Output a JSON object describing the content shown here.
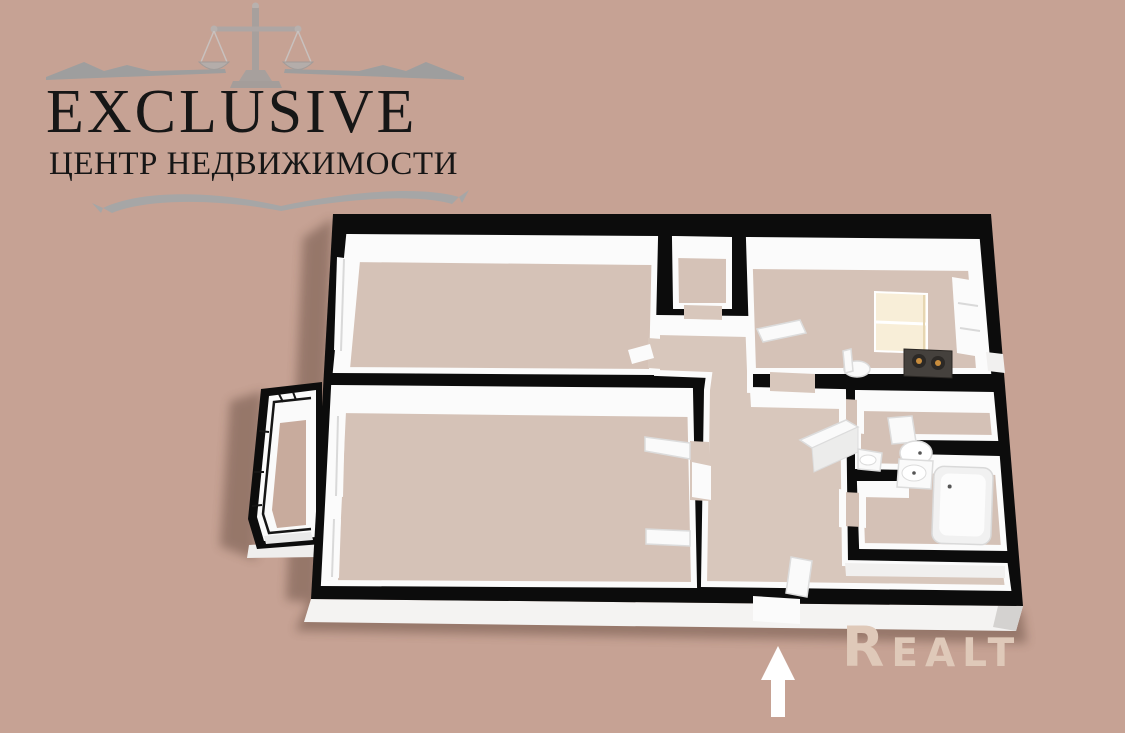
{
  "canvas": {
    "width": 1125,
    "height": 733
  },
  "colors": {
    "background": "#c6a294",
    "logo_ink": "#161616",
    "silver": "#a0a0a0",
    "silver_light": "#d2d2d2",
    "wall_black": "#0c0c0c",
    "wall_white": "#fbfbfb",
    "floor": "#d5c2b7",
    "floor_hall": "#d8c7bc",
    "floor_bath": "#d4c1b6",
    "balcony_floor": "#c8ab9d",
    "cream_window": "#f8eed8",
    "stove_dark": "#45413d",
    "burner_orange": "#c98d3d",
    "skirt_white": "#f4f3f2",
    "shadow": "#4a3326",
    "watermark": "#dfc9b9",
    "arrow_white": "#ffffff"
  },
  "logo": {
    "icon": "scales-of-justice",
    "title": "EXCLUSIVE",
    "subtitle": "ЦЕНТР НЕДВИЖИМОСТИ"
  },
  "watermark": {
    "label": "Realt"
  },
  "floor_plan": {
    "type": "3d-apartment-floor-plan",
    "view": "axonometric-top-down",
    "entrance_marker": "up-arrow",
    "rooms": [
      {
        "name": "living-room",
        "position": "top-left",
        "fixtures": [
          "window"
        ]
      },
      {
        "name": "storage-closet",
        "position": "top-center",
        "fixtures": []
      },
      {
        "name": "kitchen",
        "position": "top-right",
        "fixtures": [
          "stove",
          "window-with-cream-blinds",
          "chair",
          "side-window",
          "open-door"
        ]
      },
      {
        "name": "bedroom",
        "position": "bottom-left",
        "fixtures": [
          "open-door",
          "shelf",
          "window",
          "balcony-door"
        ]
      },
      {
        "name": "balcony",
        "position": "left",
        "fixtures": [
          "glazing"
        ]
      },
      {
        "name": "hallway",
        "position": "center",
        "fixtures": [
          "wardrobe-table"
        ]
      },
      {
        "name": "wc",
        "position": "right-upper",
        "fixtures": [
          "toilet",
          "corner-sink"
        ]
      },
      {
        "name": "bathroom",
        "position": "right-lower",
        "fixtures": [
          "sink",
          "bathtub"
        ]
      },
      {
        "name": "entry-hall",
        "position": "bottom-right",
        "fixtures": [
          "open-door",
          "entrance-doorway"
        ]
      }
    ]
  }
}
